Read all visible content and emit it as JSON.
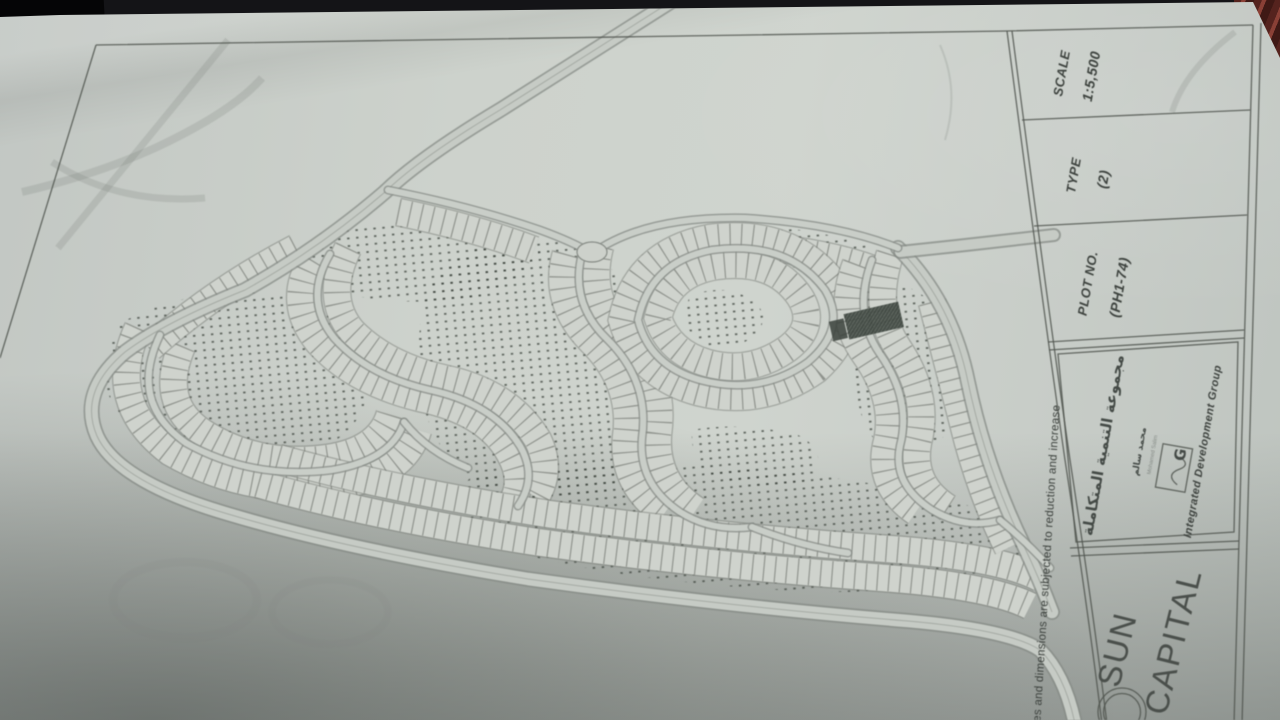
{
  "photo": {
    "background_color": "#141417",
    "paper_color": "#cdd2cc",
    "ink_color": "#50554f",
    "stipple_color": "#3f463f",
    "highlight_plot_color": "#39413b",
    "red_object_color": "#8a4036"
  },
  "title_block": {
    "scale": {
      "label": "SCALE",
      "value": "1:5,500"
    },
    "type": {
      "label": "TYPE",
      "value": "(2)"
    },
    "plot_no": {
      "label": "PLOT NO.",
      "value": "(PH1-74)"
    },
    "developer": {
      "name_ar": "مجموعة التنمية المتكاملة",
      "signature_ar": "محمد سالم",
      "signature_en": "Mohamed Salim",
      "logo_letter": "G",
      "name_en": "Integrated Development Group"
    },
    "project": {
      "line1": "SUN",
      "line2": "CAPITAL"
    }
  },
  "disclaimer": "ces and dimensions are subjected to reduction and increase",
  "map": {
    "kind": "master-plan site map",
    "highlighted_plot": "PH1-74",
    "scale": "1:5,500"
  }
}
